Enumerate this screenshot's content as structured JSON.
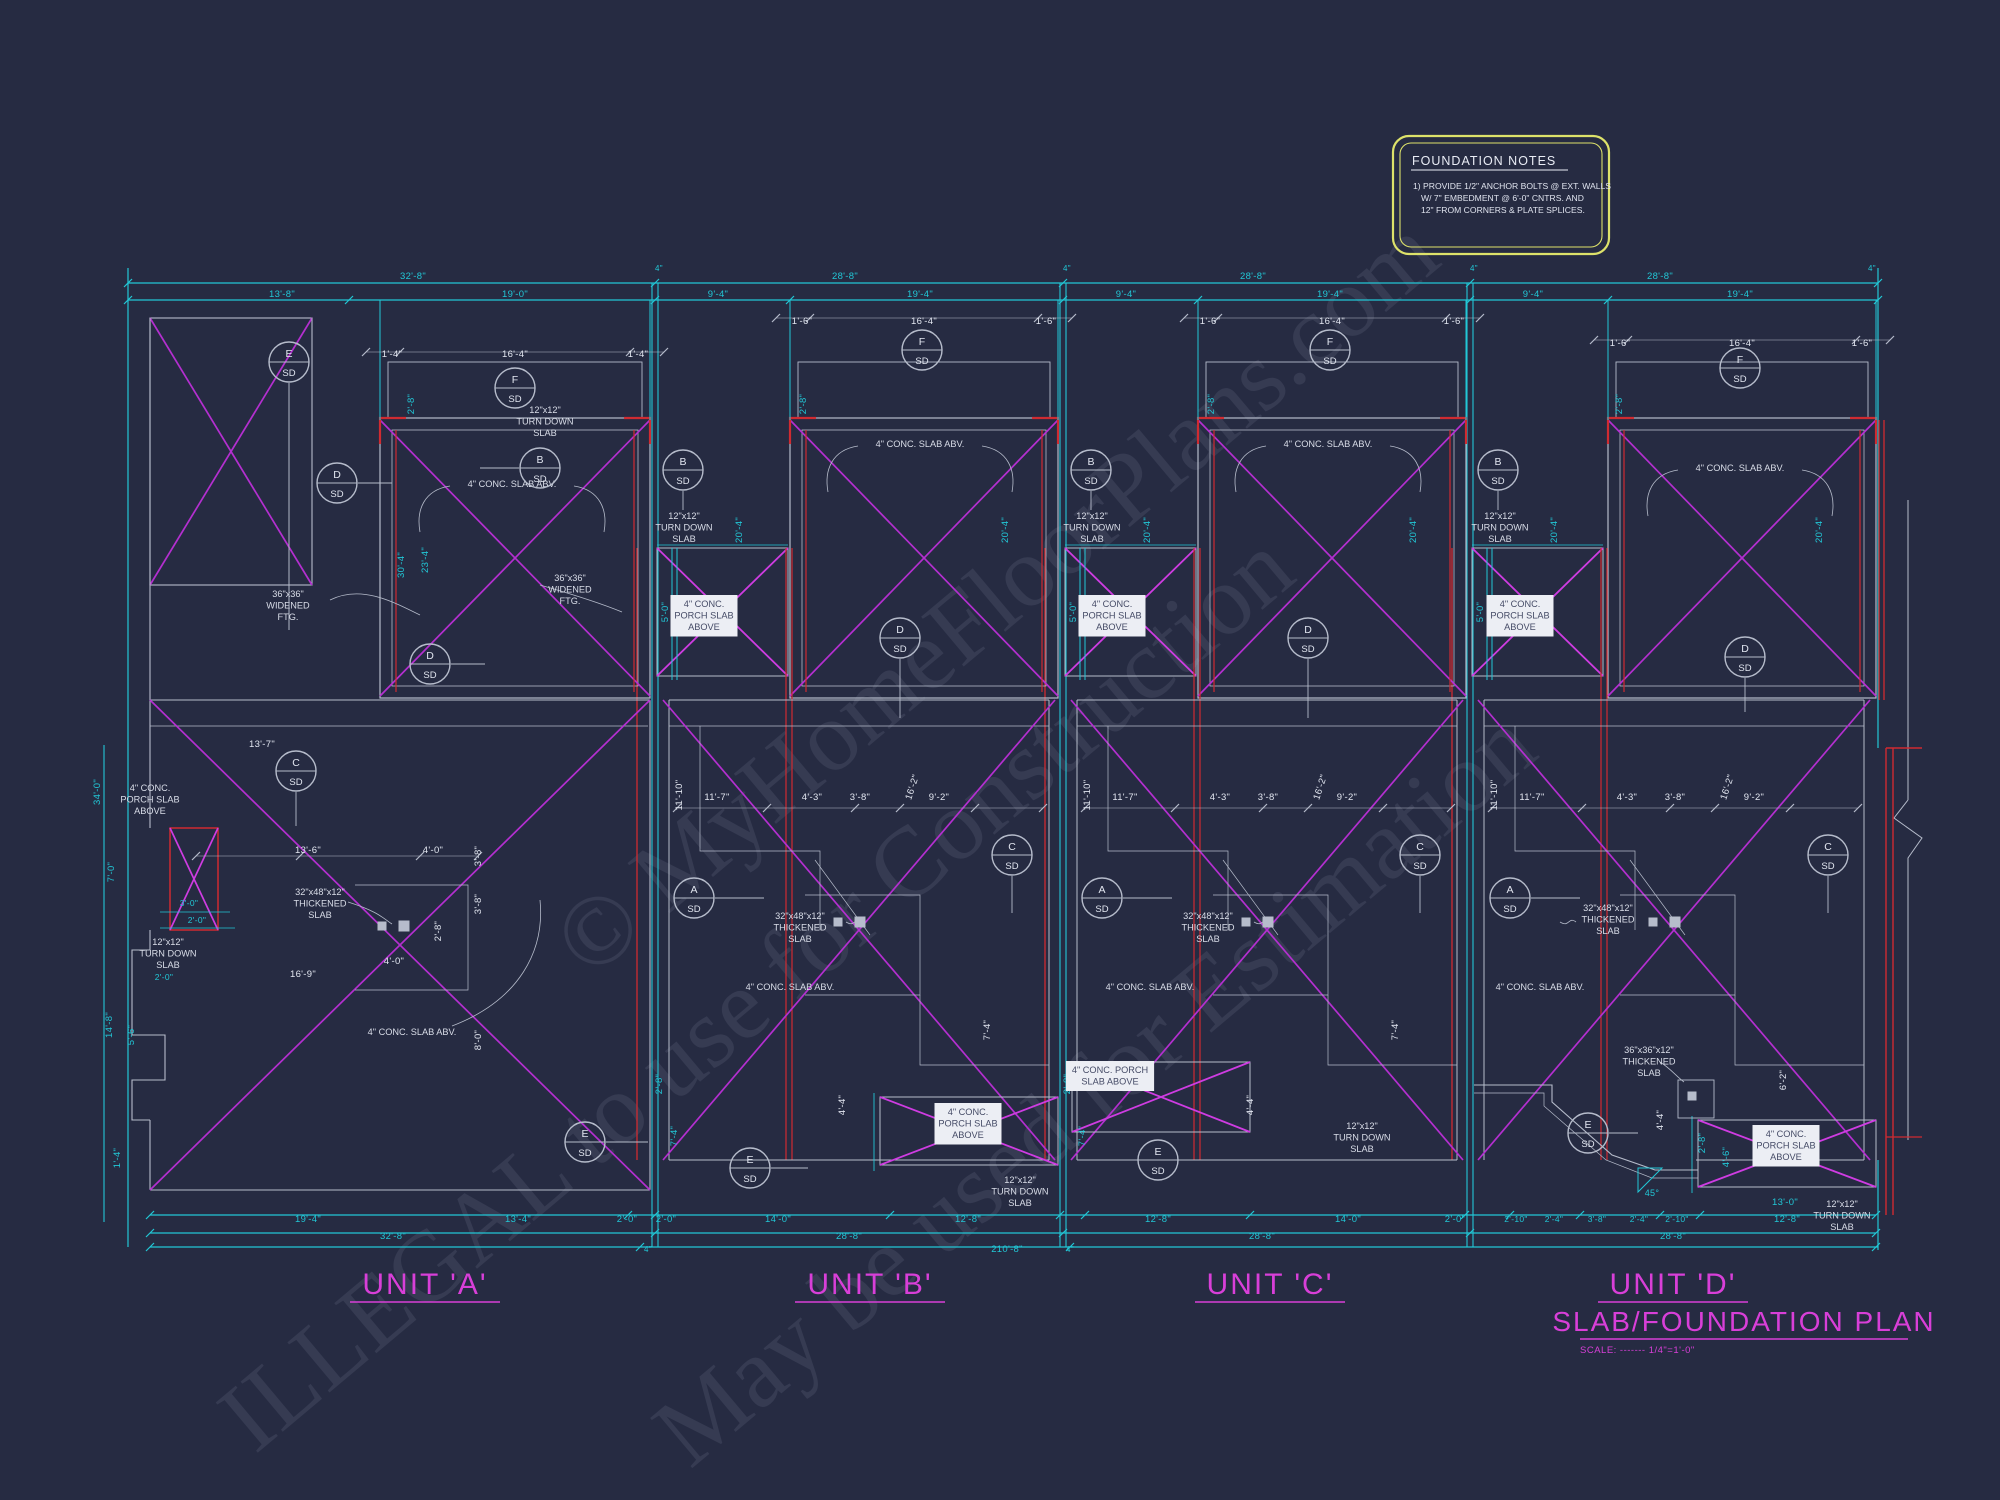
{
  "drawing": {
    "units": [
      {
        "label": "UNIT 'A'",
        "x": 425,
        "y": 1294
      },
      {
        "label": "UNIT 'B'",
        "x": 870,
        "y": 1294
      },
      {
        "label": "UNIT 'C'",
        "x": 1270,
        "y": 1294
      },
      {
        "label": "UNIT 'D'",
        "x": 1673,
        "y": 1294
      }
    ],
    "title": "SLAB/FOUNDATION PLAN",
    "scale_note": "SCALE: ------- 1/4\"=1'-0\""
  },
  "foundation_notes": {
    "title": "FOUNDATION NOTES",
    "line1": "1) PROVIDE 1/2\" ANCHOR BOLTS @ EXT. WALLS",
    "line2": "W/ 7\" EMBEDMENT @ 6'-0\" CNTRS. AND",
    "line3": "12\" FROM CORNERS & PLATE SPLICES."
  },
  "watermarks": [
    {
      "text": "© MyHomeFloorPlans.com",
      "x": 590,
      "y": 980,
      "r": -40,
      "s": 100
    },
    {
      "text": "ILLEGAL to use for Construction",
      "x": 255,
      "y": 1455,
      "r": -40,
      "s": 100
    },
    {
      "text": "May be used for Estimation",
      "x": 690,
      "y": 1470,
      "r": -40,
      "s": 100
    }
  ],
  "callout_detail": "SD",
  "callouts": [
    {
      "l": "E",
      "x": 289,
      "y": 362,
      "ldr": [
        0,
        21,
        0,
        268
      ]
    },
    {
      "l": "F",
      "x": 515,
      "y": 388
    },
    {
      "l": "B",
      "x": 540,
      "y": 468,
      "ldr": [
        -21,
        0,
        -60,
        0
      ]
    },
    {
      "l": "D",
      "x": 337,
      "y": 483,
      "ldr": [
        21,
        0,
        55,
        0
      ]
    },
    {
      "l": "D",
      "x": 430,
      "y": 664,
      "ldr": [
        21,
        0,
        55,
        0
      ]
    },
    {
      "l": "C",
      "x": 296,
      "y": 771,
      "ldr": [
        0,
        21,
        0,
        55
      ]
    },
    {
      "l": "E",
      "x": 585,
      "y": 1142,
      "ldr": [
        21,
        0,
        63,
        0
      ]
    },
    {
      "l": "F",
      "x": 922,
      "y": 350
    },
    {
      "l": "B",
      "x": 683,
      "y": 470,
      "ldr": [
        0,
        21,
        0,
        40
      ]
    },
    {
      "l": "D",
      "x": 900,
      "y": 638,
      "ldr": [
        0,
        21,
        0,
        80
      ]
    },
    {
      "l": "C",
      "x": 1012,
      "y": 855,
      "ldr": [
        0,
        21,
        0,
        58
      ]
    },
    {
      "l": "A",
      "x": 694,
      "y": 898,
      "ldr": [
        21,
        0,
        70,
        0
      ]
    },
    {
      "l": "E",
      "x": 750,
      "y": 1168,
      "ldr": [
        21,
        0,
        58,
        0
      ]
    },
    {
      "l": "F",
      "x": 1330,
      "y": 350
    },
    {
      "l": "B",
      "x": 1091,
      "y": 470,
      "ldr": [
        0,
        21,
        0,
        40
      ]
    },
    {
      "l": "D",
      "x": 1308,
      "y": 638,
      "ldr": [
        0,
        21,
        0,
        80
      ]
    },
    {
      "l": "C",
      "x": 1420,
      "y": 855,
      "ldr": [
        0,
        21,
        0,
        58
      ]
    },
    {
      "l": "A",
      "x": 1102,
      "y": 898,
      "ldr": [
        21,
        0,
        70,
        0
      ]
    },
    {
      "l": "E",
      "x": 1158,
      "y": 1160,
      "ldr": [
        21,
        0,
        58,
        0
      ]
    },
    {
      "l": "F",
      "x": 1740,
      "y": 368
    },
    {
      "l": "B",
      "x": 1498,
      "y": 470,
      "ldr": [
        0,
        21,
        0,
        40
      ]
    },
    {
      "l": "D",
      "x": 1745,
      "y": 657,
      "ldr": [
        0,
        21,
        0,
        55
      ]
    },
    {
      "l": "C",
      "x": 1828,
      "y": 855,
      "ldr": [
        0,
        21,
        0,
        58
      ]
    },
    {
      "l": "A",
      "x": 1510,
      "y": 898,
      "ldr": [
        21,
        0,
        70,
        0
      ]
    },
    {
      "l": "E",
      "x": 1588,
      "y": 1133,
      "ldr": [
        21,
        0,
        50,
        0
      ]
    }
  ],
  "dim_labels": [
    {
      "t": "32'-8\"",
      "x": 413,
      "y": 279
    },
    {
      "t": "28'-8\"",
      "x": 845,
      "y": 279
    },
    {
      "t": "28'-8\"",
      "x": 1253,
      "y": 279
    },
    {
      "t": "28'-8\"",
      "x": 1660,
      "y": 279
    },
    {
      "t": "4\"",
      "x": 659,
      "y": 271,
      "s": 8
    },
    {
      "t": "4\"",
      "x": 1067,
      "y": 271,
      "s": 8
    },
    {
      "t": "4\"",
      "x": 1474,
      "y": 271,
      "s": 8
    },
    {
      "t": "4\"",
      "x": 1872,
      "y": 271,
      "s": 8
    },
    {
      "t": "13'-8\"",
      "x": 282,
      "y": 297
    },
    {
      "t": "19'-0\"",
      "x": 515,
      "y": 297
    },
    {
      "t": "9'-4\"",
      "x": 718,
      "y": 297
    },
    {
      "t": "19'-4\"",
      "x": 920,
      "y": 297
    },
    {
      "t": "9'-4\"",
      "x": 1126,
      "y": 297
    },
    {
      "t": "19'-4\"",
      "x": 1330,
      "y": 297
    },
    {
      "t": "9'-4\"",
      "x": 1533,
      "y": 297
    },
    {
      "t": "19'-4\"",
      "x": 1740,
      "y": 297
    },
    {
      "t": "1'-4\"",
      "x": 392,
      "y": 357,
      "c": "w"
    },
    {
      "t": "16'-4\"",
      "x": 515,
      "y": 357,
      "c": "w"
    },
    {
      "t": "1'-4\"",
      "x": 638,
      "y": 357,
      "c": "w"
    },
    {
      "t": "1'-6\"",
      "x": 802,
      "y": 324,
      "c": "w"
    },
    {
      "t": "16'-4\"",
      "x": 924,
      "y": 324,
      "c": "w"
    },
    {
      "t": "1'-6\"",
      "x": 1046,
      "y": 324,
      "c": "w"
    },
    {
      "t": "1'-6\"",
      "x": 1210,
      "y": 324,
      "c": "w"
    },
    {
      "t": "16'-4\"",
      "x": 1332,
      "y": 324,
      "c": "w"
    },
    {
      "t": "1'-6\"",
      "x": 1454,
      "y": 324,
      "c": "w"
    },
    {
      "t": "1'-6\"",
      "x": 1620,
      "y": 346,
      "c": "w"
    },
    {
      "t": "16'-4\"",
      "x": 1742,
      "y": 346,
      "c": "w"
    },
    {
      "t": "1'-6\"",
      "x": 1862,
      "y": 346,
      "c": "w"
    },
    {
      "t": "2'-8\"",
      "x": 414,
      "y": 404,
      "r": -90
    },
    {
      "t": "30'-4\"",
      "x": 404,
      "y": 565,
      "r": -90
    },
    {
      "t": "23'-4\"",
      "x": 428,
      "y": 560,
      "r": -90
    },
    {
      "t": "5'-0\"",
      "x": 668,
      "y": 612,
      "r": -90
    },
    {
      "t": "20'-4\"",
      "x": 742,
      "y": 530,
      "r": -90
    },
    {
      "t": "2'-8\"",
      "x": 806,
      "y": 404,
      "r": -90
    },
    {
      "t": "20'-4\"",
      "x": 1008,
      "y": 530,
      "r": -90
    },
    {
      "t": "5'-0\"",
      "x": 1076,
      "y": 612,
      "r": -90
    },
    {
      "t": "20'-4\"",
      "x": 1150,
      "y": 530,
      "r": -90
    },
    {
      "t": "2'-8\"",
      "x": 1214,
      "y": 404,
      "r": -90
    },
    {
      "t": "20'-4\"",
      "x": 1416,
      "y": 530,
      "r": -90
    },
    {
      "t": "5'-0\"",
      "x": 1483,
      "y": 612,
      "r": -90
    },
    {
      "t": "20'-4\"",
      "x": 1557,
      "y": 530,
      "r": -90
    },
    {
      "t": "2'-8\"",
      "x": 1622,
      "y": 404,
      "r": -90
    },
    {
      "t": "20'-4\"",
      "x": 1822,
      "y": 530,
      "r": -90
    },
    {
      "t": "34'-0\"",
      "x": 100,
      "y": 792,
      "r": -90
    },
    {
      "t": "7'-0\"",
      "x": 114,
      "y": 872,
      "r": -90
    },
    {
      "t": "3'-0\"",
      "x": 189,
      "y": 906,
      "s": 8.5
    },
    {
      "t": "2'-0\"",
      "x": 197,
      "y": 923,
      "s": 8.5
    },
    {
      "t": "2'-0\"",
      "x": 164,
      "y": 980,
      "s": 8.5
    },
    {
      "t": "14'-8\"",
      "x": 112,
      "y": 1025,
      "r": -90
    },
    {
      "t": "5'-6\"",
      "x": 134,
      "y": 1035,
      "r": -90
    },
    {
      "t": "1'-4\"",
      "x": 120,
      "y": 1158,
      "r": -90
    },
    {
      "t": "13'-7\"",
      "x": 262,
      "y": 747,
      "c": "w"
    },
    {
      "t": "13'-6\"",
      "x": 308,
      "y": 853,
      "c": "w"
    },
    {
      "t": "4'-0\"",
      "x": 433,
      "y": 853,
      "c": "w"
    },
    {
      "t": "3'-8\"",
      "x": 481,
      "y": 856,
      "c": "w",
      "r": -90
    },
    {
      "t": "3'-8\"",
      "x": 481,
      "y": 904,
      "c": "w",
      "r": -90
    },
    {
      "t": "2'-8\"",
      "x": 441,
      "y": 931,
      "c": "w",
      "r": -90
    },
    {
      "t": "4'-0\"",
      "x": 394,
      "y": 964,
      "c": "w"
    },
    {
      "t": "16'-9\"",
      "x": 303,
      "y": 977,
      "c": "w"
    },
    {
      "t": "8'-0\"",
      "x": 481,
      "y": 1040,
      "c": "w",
      "r": -90
    },
    {
      "t": "11'-10\"",
      "x": 682,
      "y": 795,
      "c": "w",
      "r": -90
    },
    {
      "t": "11'-7\"",
      "x": 717,
      "y": 800,
      "c": "w"
    },
    {
      "t": "4'-3\"",
      "x": 812,
      "y": 800,
      "c": "w"
    },
    {
      "t": "3'-8\"",
      "x": 860,
      "y": 800,
      "c": "w"
    },
    {
      "t": "9'-2\"",
      "x": 939,
      "y": 800,
      "c": "w"
    },
    {
      "t": "16'-2\"",
      "x": 915,
      "y": 788,
      "c": "w",
      "r": -72
    },
    {
      "t": "11'-10\"",
      "x": 1090,
      "y": 795,
      "c": "w",
      "r": -90
    },
    {
      "t": "11'-7\"",
      "x": 1125,
      "y": 800,
      "c": "w"
    },
    {
      "t": "4'-3\"",
      "x": 1220,
      "y": 800,
      "c": "w"
    },
    {
      "t": "3'-8\"",
      "x": 1268,
      "y": 800,
      "c": "w"
    },
    {
      "t": "9'-2\"",
      "x": 1347,
      "y": 800,
      "c": "w"
    },
    {
      "t": "16'-2\"",
      "x": 1323,
      "y": 788,
      "c": "w",
      "r": -72
    },
    {
      "t": "11'-10\"",
      "x": 1497,
      "y": 795,
      "c": "w",
      "r": -90
    },
    {
      "t": "11'-7\"",
      "x": 1532,
      "y": 800,
      "c": "w"
    },
    {
      "t": "4'-3\"",
      "x": 1627,
      "y": 800,
      "c": "w"
    },
    {
      "t": "3'-8\"",
      "x": 1675,
      "y": 800,
      "c": "w"
    },
    {
      "t": "9'-2\"",
      "x": 1754,
      "y": 800,
      "c": "w"
    },
    {
      "t": "16'-2\"",
      "x": 1730,
      "y": 788,
      "c": "w",
      "r": -72
    },
    {
      "t": "2'-8\"",
      "x": 662,
      "y": 1084,
      "r": -90
    },
    {
      "t": "7'-4\"",
      "x": 677,
      "y": 1136,
      "r": -90
    },
    {
      "t": "4'-4\"",
      "x": 845,
      "y": 1105,
      "c": "w",
      "r": -90
    },
    {
      "t": "7'-4\"",
      "x": 990,
      "y": 1030,
      "c": "w",
      "r": -90
    },
    {
      "t": "2'-8\"",
      "x": 1070,
      "y": 1084,
      "r": -90
    },
    {
      "t": "7'-4\"",
      "x": 1085,
      "y": 1136,
      "r": -90
    },
    {
      "t": "4'-4\"",
      "x": 1253,
      "y": 1105,
      "c": "w",
      "r": -90
    },
    {
      "t": "7'-4\"",
      "x": 1398,
      "y": 1030,
      "c": "w",
      "r": -90
    },
    {
      "t": "2'-8\"",
      "x": 1705,
      "y": 1143,
      "r": -90
    },
    {
      "t": "4'-6\"",
      "x": 1729,
      "y": 1157,
      "r": -90
    },
    {
      "t": "4'-4\"",
      "x": 1663,
      "y": 1120,
      "c": "w",
      "r": -90
    },
    {
      "t": "6'-2\"",
      "x": 1786,
      "y": 1080,
      "c": "w",
      "r": -90
    },
    {
      "t": "19'-4\"",
      "x": 308,
      "y": 1222
    },
    {
      "t": "13'-4\"",
      "x": 518,
      "y": 1222
    },
    {
      "t": "2'-0\"",
      "x": 627,
      "y": 1222
    },
    {
      "t": "32'-8\"",
      "x": 393,
      "y": 1239
    },
    {
      "t": "4\"",
      "x": 648,
      "y": 1252,
      "s": 8
    },
    {
      "t": "2'-0\"",
      "x": 666,
      "y": 1222
    },
    {
      "t": "14'-0\"",
      "x": 778,
      "y": 1222
    },
    {
      "t": "12'-8\"",
      "x": 968,
      "y": 1222
    },
    {
      "t": "28'-8\"",
      "x": 849,
      "y": 1239
    },
    {
      "t": "210'-8\"",
      "x": 1007,
      "y": 1252
    },
    {
      "t": "4\"",
      "x": 1070,
      "y": 1252,
      "s": 8
    },
    {
      "t": "12'-8\"",
      "x": 1158,
      "y": 1222
    },
    {
      "t": "14'-0\"",
      "x": 1348,
      "y": 1222
    },
    {
      "t": "2'-0\"",
      "x": 1455,
      "y": 1222
    },
    {
      "t": "28'-8\"",
      "x": 1262,
      "y": 1239
    },
    {
      "t": "2'-10\"",
      "x": 1516,
      "y": 1222,
      "s": 8.5
    },
    {
      "t": "2'-4\"",
      "x": 1554,
      "y": 1222,
      "s": 8.5
    },
    {
      "t": "3'-8\"",
      "x": 1597,
      "y": 1222,
      "s": 8.5
    },
    {
      "t": "2'-4\"",
      "x": 1639,
      "y": 1222,
      "s": 8.5
    },
    {
      "t": "2'-10\"",
      "x": 1677,
      "y": 1222,
      "s": 8.5
    },
    {
      "t": "13'-0\"",
      "x": 1785,
      "y": 1205
    },
    {
      "t": "12'-8\"",
      "x": 1787,
      "y": 1222
    },
    {
      "t": "28'-8\"",
      "x": 1673,
      "y": 1239
    },
    {
      "t": "45°",
      "x": 1652,
      "y": 1196,
      "s": 9
    }
  ],
  "annotations": [
    {
      "lines": [
        "36\"x36\"",
        "WIDENED",
        "FTG."
      ],
      "x": 288,
      "y": 588
    },
    {
      "lines": [
        "36\"x36\"",
        "WIDENED",
        "FTG."
      ],
      "x": 570,
      "y": 572
    },
    {
      "lines": [
        "4\" CONC. SLAB ABV."
      ],
      "x": 512,
      "y": 478
    },
    {
      "lines": [
        "4\" CONC.",
        "PORCH SLAB",
        "ABOVE"
      ],
      "x": 150,
      "y": 782
    },
    {
      "lines": [
        "12\"x12\"",
        "TURN DOWN",
        "SLAB"
      ],
      "x": 168,
      "y": 936
    },
    {
      "lines": [
        "32\"x48\"x12\"",
        "THICKENED",
        "SLAB"
      ],
      "x": 320,
      "y": 886
    },
    {
      "lines": [
        "4\" CONC. SLAB ABV."
      ],
      "x": 412,
      "y": 1026
    },
    {
      "lines": [
        "12\"x12\"",
        "TURN DOWN",
        "SLAB"
      ],
      "x": 545,
      "y": 404
    },
    {
      "lines": [
        "4\" CONC.",
        "PORCH SLAB",
        "ABOVE"
      ],
      "x": 704,
      "y": 598,
      "boxed": true
    },
    {
      "lines": [
        "12\"x12\"",
        "TURN DOWN",
        "SLAB"
      ],
      "x": 684,
      "y": 510
    },
    {
      "lines": [
        "4\" CONC. SLAB ABV."
      ],
      "x": 920,
      "y": 438
    },
    {
      "lines": [
        "32\"x48\"x12\"",
        "THICKENED",
        "SLAB"
      ],
      "x": 800,
      "y": 910
    },
    {
      "lines": [
        "4\" CONC. SLAB ABV."
      ],
      "x": 790,
      "y": 981
    },
    {
      "lines": [
        "4\" CONC.",
        "PORCH SLAB",
        "ABOVE"
      ],
      "x": 968,
      "y": 1106,
      "boxed": true
    },
    {
      "lines": [
        "12\"x12\"",
        "TURN DOWN",
        "SLAB"
      ],
      "x": 1020,
      "y": 1174
    },
    {
      "lines": [
        "4\" CONC.",
        "PORCH SLAB",
        "ABOVE"
      ],
      "x": 1112,
      "y": 598,
      "boxed": true
    },
    {
      "lines": [
        "12\"x12\"",
        "TURN DOWN",
        "SLAB"
      ],
      "x": 1092,
      "y": 510
    },
    {
      "lines": [
        "4\" CONC. SLAB ABV."
      ],
      "x": 1328,
      "y": 438
    },
    {
      "lines": [
        "32\"x48\"x12\"",
        "THICKENED",
        "SLAB"
      ],
      "x": 1208,
      "y": 910
    },
    {
      "lines": [
        "4\" CONC. SLAB ABV."
      ],
      "x": 1150,
      "y": 981
    },
    {
      "lines": [
        "4\" CONC. PORCH",
        "SLAB ABOVE"
      ],
      "x": 1110,
      "y": 1064,
      "boxed": true
    },
    {
      "lines": [
        "12\"x12\"",
        "TURN DOWN",
        "SLAB"
      ],
      "x": 1362,
      "y": 1120
    },
    {
      "lines": [
        "4\" CONC.",
        "PORCH SLAB",
        "ABOVE"
      ],
      "x": 1520,
      "y": 598,
      "boxed": true
    },
    {
      "lines": [
        "12\"x12\"",
        "TURN DOWN",
        "SLAB"
      ],
      "x": 1500,
      "y": 510
    },
    {
      "lines": [
        "4\" CONC. SLAB ABV."
      ],
      "x": 1740,
      "y": 462
    },
    {
      "lines": [
        "32\"x48\"x12\"",
        "THICKENED",
        "SLAB"
      ],
      "x": 1608,
      "y": 902
    },
    {
      "lines": [
        "4\" CONC. SLAB ABV."
      ],
      "x": 1540,
      "y": 981
    },
    {
      "lines": [
        "36\"x36\"x12\"",
        "THICKENED",
        "SLAB"
      ],
      "x": 1649,
      "y": 1044
    },
    {
      "lines": [
        "4\" CONC.",
        "PORCH SLAB",
        "ABOVE"
      ],
      "x": 1786,
      "y": 1128,
      "boxed": true
    },
    {
      "lines": [
        "12\"x12\"",
        "TURN DOWN",
        "SLAB"
      ],
      "x": 1842,
      "y": 1198
    }
  ],
  "colors": {
    "background": "#262b42",
    "cyan": "#22c7d6",
    "wall": "#b6bccb",
    "text_white": "#e2e6f0",
    "magenta": "#b42fd0",
    "magenta_bright": "#cf3ce2",
    "red": "#cf2b31",
    "unit_label": "#d83fd8",
    "notes_border": "#dde26a",
    "label_box_bg": "#eceef4",
    "label_box_text": "#454b66",
    "watermark": "#a6abc8"
  }
}
